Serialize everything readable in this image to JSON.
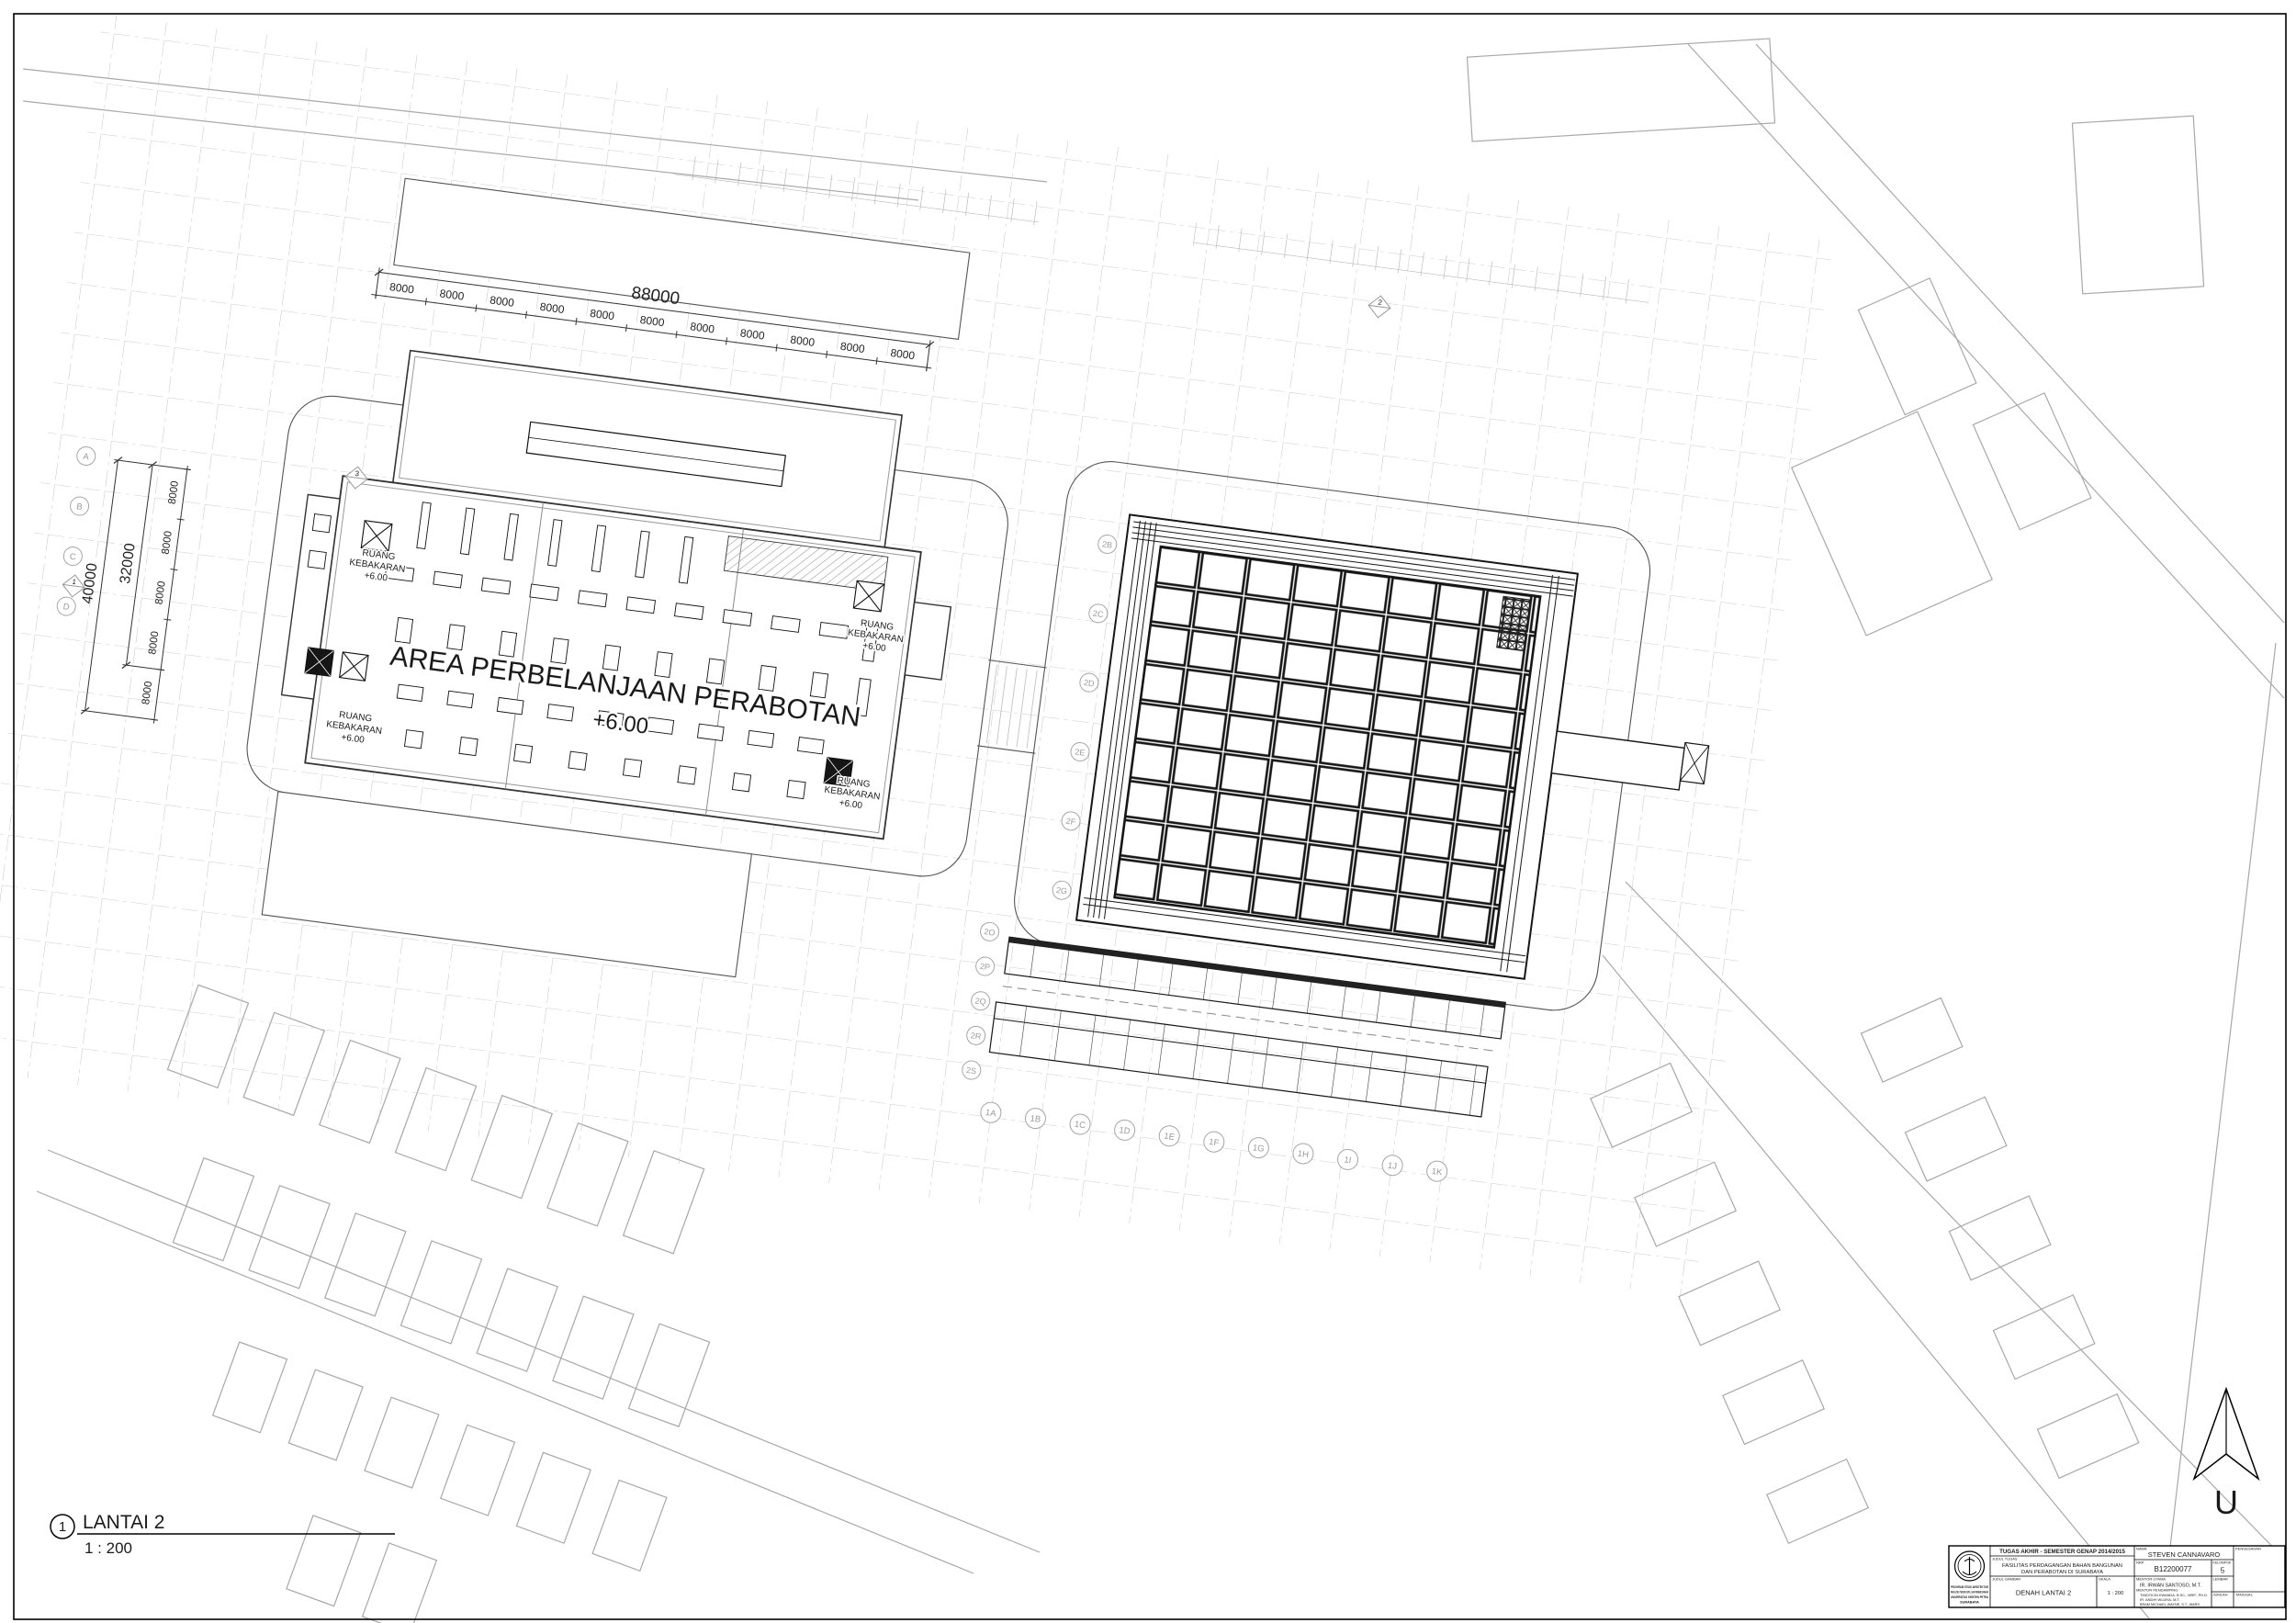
{
  "sheet": {
    "view_number": "1",
    "view_title": "LANTAI 2",
    "view_scale": "1 : 200",
    "north_label": "U"
  },
  "plan": {
    "area_label": "AREA PERBELANJAAN PERABOTAN",
    "area_level": "+6.00",
    "fire_room_line1": "RUANG",
    "fire_room_line2": "KEBAKARAN",
    "fire_room_level": "+6.00",
    "section_marker_1": "1",
    "section_marker_2": "2",
    "section_marker_3": "3"
  },
  "dimensions": {
    "top_total": "88000",
    "segment": "8000",
    "left_total": "40000",
    "left_inner": "32000"
  },
  "grid_bubbles": {
    "bottom": [
      "1A",
      "1B",
      "1C",
      "1D",
      "1E",
      "1F",
      "1G",
      "1H",
      "1I",
      "1J",
      "1K"
    ],
    "left_col": [
      "2O",
      "2P",
      "2Q",
      "2R",
      "2S"
    ],
    "right_building_left": [
      "2B",
      "2C",
      "2D",
      "2E",
      "2F",
      "2G"
    ],
    "site_left": [
      "A",
      "B",
      "C",
      "D"
    ]
  },
  "title_block": {
    "header": "TUGAS AKHIR - SEMESTER GENAP 2014/2015",
    "labels": {
      "judul_tugas": "JUDUL TUGAS",
      "judul_gambar": "JUDUL GAMBAR",
      "skala": "SKALA",
      "nama": "NAMA",
      "nrp": "NRP",
      "kelompok": "KELOMPOK",
      "mentor_utama": "MENTOR UTAMA",
      "mentor_pendamping": "MENTOR PENDAMPING",
      "lembar": "LEMBAR",
      "jumlah": "JUMLAH",
      "tanggal": "TANGGAL",
      "pengesahan": "PENGESAHAN"
    },
    "judul_tugas_line1": "FASILITAS PERDAGANGAN BAHAN BANGUNAN",
    "judul_tugas_line2": "DAN PERABOTAN DI SURABAYA",
    "judul_gambar": "DENAH LANTAI 2",
    "skala": "1 : 200",
    "nama": "STEVEN CANNAVARO",
    "nrp": "B12200077",
    "kelompok": "5",
    "mentor_utama": "IR. IRWAN SANTOSO, M.T.",
    "mentor_pendamping_1": "TIMOTICIN KWANDA, B.SC., MRP., PH.D.",
    "mentor_pendamping_2": "IR. ANDHI WIJAYA, M.T.",
    "mentor_pendamping_3": "BRAM MICHAEL WAYNE, S.T., MARS.",
    "institution_line1": "PROGRAM STUDI ARSITEKTUR",
    "institution_line2": "FAKULTAS TEKNIK SIPIL DAN PERENCANAAN",
    "institution_line3": "UNIVERSITAS KRISTEN PETRA",
    "institution_line4": "SURABAYA"
  },
  "colors": {
    "drawing_line": "#1a1a1a",
    "site_line": "#a8a8a8",
    "grid_line": "#c4c4c4",
    "wall_gray": "#8a8a8a"
  }
}
